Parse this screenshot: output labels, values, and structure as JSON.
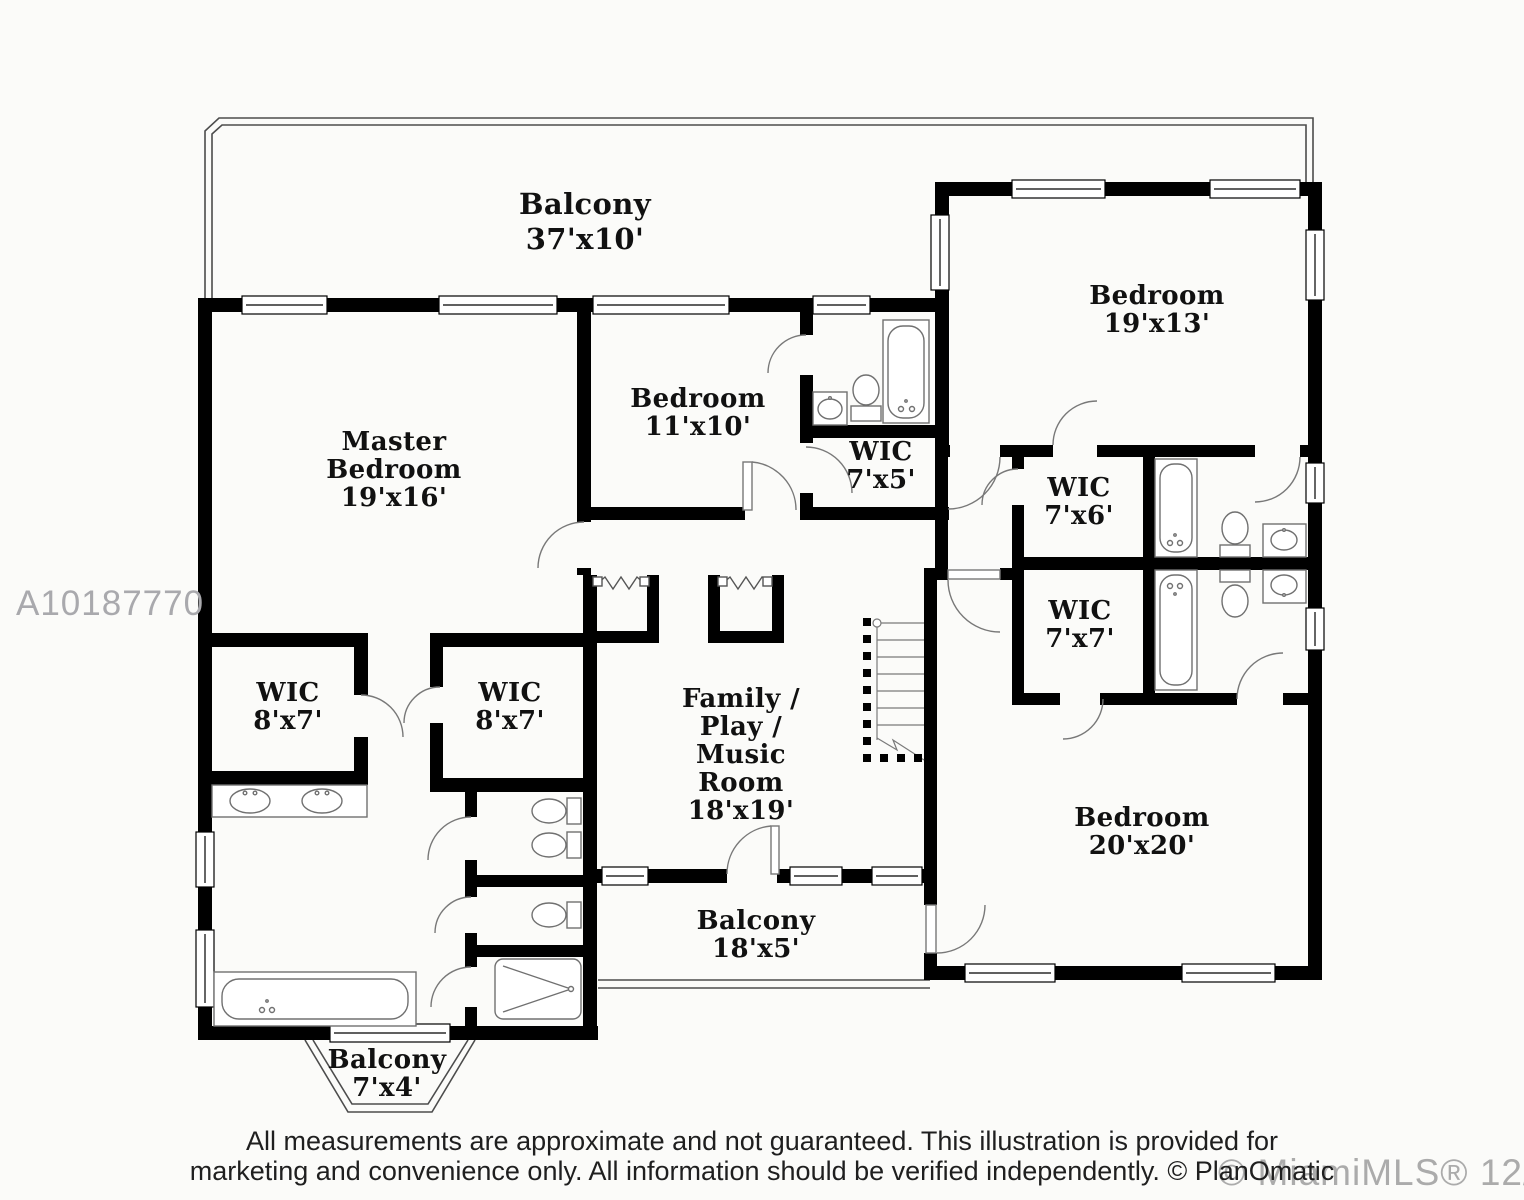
{
  "plan": {
    "rooms": [
      {
        "id": "balcony-top",
        "name": "Balcony",
        "dims": "37'x10'"
      },
      {
        "id": "bedroom-top-right",
        "name": "Bedroom",
        "dims": "19'x13'"
      },
      {
        "id": "master-bedroom",
        "name": "Master\nBedroom",
        "dims": "19'x16'"
      },
      {
        "id": "bedroom-center",
        "name": "Bedroom",
        "dims": "11'x10'"
      },
      {
        "id": "wic-7x5",
        "name": "WIC",
        "dims": "7'x5'"
      },
      {
        "id": "wic-7x6",
        "name": "WIC",
        "dims": "7'x6'"
      },
      {
        "id": "wic-7x7",
        "name": "WIC",
        "dims": "7'x7'"
      },
      {
        "id": "wic-8x7-left",
        "name": "WIC",
        "dims": "8'x7'"
      },
      {
        "id": "wic-8x7-right",
        "name": "WIC",
        "dims": "8'x7'"
      },
      {
        "id": "family-room",
        "name": "Family /\nPlay /\nMusic\nRoom",
        "dims": "18'x19'"
      },
      {
        "id": "bedroom-bottom-right",
        "name": "Bedroom",
        "dims": "20'x20'"
      },
      {
        "id": "balcony-center",
        "name": "Balcony",
        "dims": "18'x5'"
      },
      {
        "id": "balcony-bay",
        "name": "Balcony",
        "dims": "7'x4'"
      }
    ]
  },
  "watermarks": {
    "listing_id": "A10187770",
    "mls_credit": "© MiamiMLS® 12/2016"
  },
  "disclaimer": {
    "line1": "All measurements are approximate and not guaranteed. This illustration is provided for",
    "line2": "marketing and convenience only. All information should be verified independently. © PlanOmatic"
  },
  "colors": {
    "wall": "#000000",
    "thin_line": "#4c4c4c",
    "fixture_line": "#707070",
    "watermark_gray": "#ababab",
    "disclaimer_text": "#1f1f1f"
  }
}
